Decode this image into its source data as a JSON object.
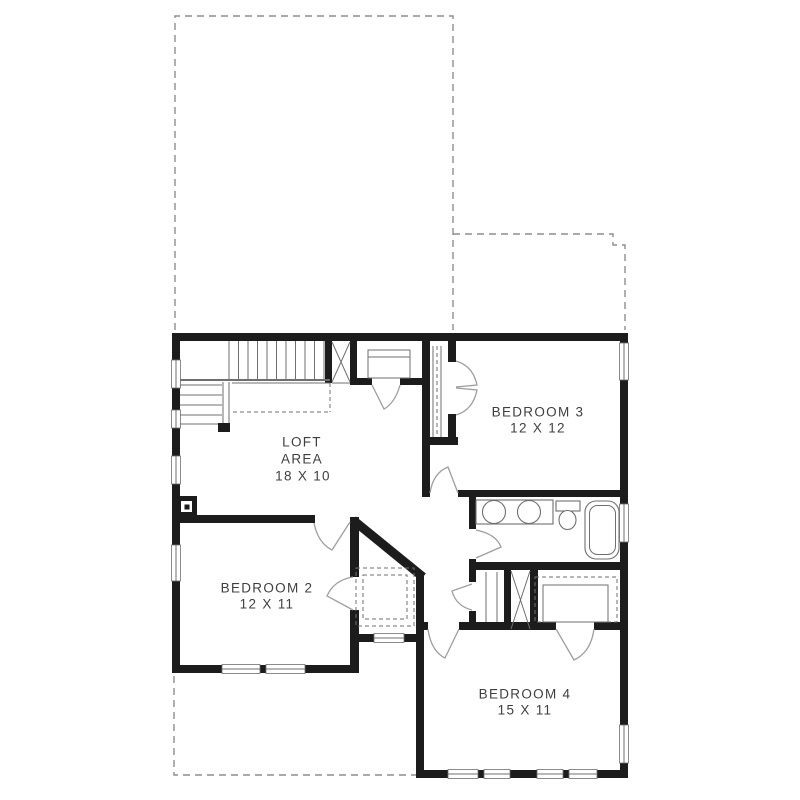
{
  "floor_plan": {
    "rooms": {
      "loft": {
        "name_line1": "LOFT",
        "name_line2": "AREA",
        "dimensions": "18 X 10"
      },
      "bedroom2": {
        "name": "BEDROOM 2",
        "dimensions": "12 X 11"
      },
      "bedroom3": {
        "name": "BEDROOM 3",
        "dimensions": "12 X 12"
      },
      "bedroom4": {
        "name": "BEDROOM 4",
        "dimensions": "15 X 11"
      }
    },
    "fixtures": [
      "staircase",
      "stairwell-opening",
      "double-sink-vanity",
      "toilet",
      "bathtub",
      "linen-closet",
      "chase",
      "bedroom-closets",
      "post-symbol"
    ],
    "colors": {
      "wall": "#1c1c1c",
      "thin_line": "#6f6f6f",
      "door_swing": "#9e9e9e",
      "dashed_outline": "#8e8e8e",
      "text": "#3f3f3f",
      "background": "#ffffff"
    }
  }
}
